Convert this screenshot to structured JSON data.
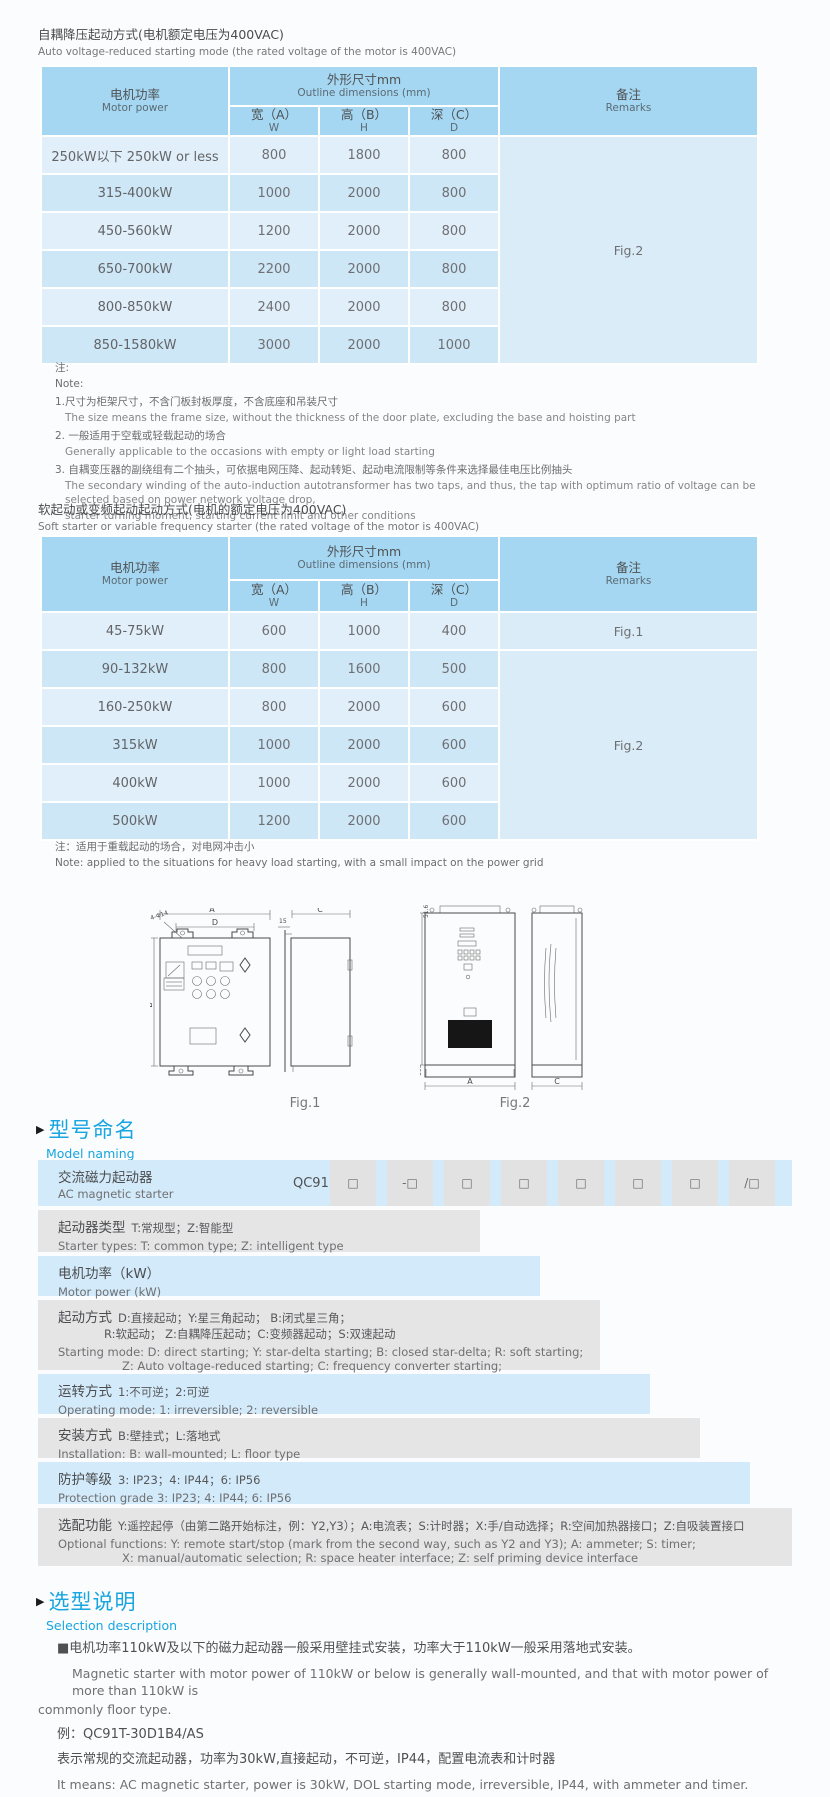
{
  "accent_blue": "#18a5e0",
  "table_header_blue": "#a5d7f2",
  "th": {
    "power_zh": "电机功率",
    "power_en": "Motor power",
    "dims_zh": "外形尺寸mm",
    "dims_en": "Outline dimensions (mm)",
    "w_zh": "宽（A）",
    "w_en": "W",
    "h_zh": "高（B）",
    "h_en": "H",
    "d_zh": "深（C）",
    "d_en": "D",
    "rem_zh": "备注",
    "rem_en": "Remarks"
  },
  "s1": {
    "title_zh": "自耦降压起动方式(电机额定电压为400VAC)",
    "title_en": "Auto voltage-reduced starting mode (the rated voltage of the motor is 400VAC)",
    "remark": "Fig.2",
    "rows": [
      {
        "power": "250kW以下 250kW or less",
        "w": "800",
        "h": "1800",
        "d": "800"
      },
      {
        "power": "315-400kW",
        "w": "1000",
        "h": "2000",
        "d": "800"
      },
      {
        "power": "450-560kW",
        "w": "1200",
        "h": "2000",
        "d": "800"
      },
      {
        "power": "650-700kW",
        "w": "2200",
        "h": "2000",
        "d": "800"
      },
      {
        "power": "800-850kW",
        "w": "2400",
        "h": "2000",
        "d": "800"
      },
      {
        "power": "850-1580kW",
        "w": "3000",
        "h": "2000",
        "d": "1000"
      }
    ],
    "notes": [
      "注:",
      "Note:",
      "1.尺寸为柜架尺寸，不含门板封板厚度，不含底座和吊装尺寸",
      "The size means the frame size, without the thickness of the door plate, excluding the base and hoisting part",
      "2. 一般适用于空载或轻载起动的场合",
      "Generally applicable to the occasions with empty or light load starting",
      "3. 自耦变压器的副绕组有二个抽头，可依据电网压降、起动转矩、起动电流限制等条件来选择最佳电压比例抽头",
      "The secondary winding of the auto-induction autotransformer has two taps, and thus, the tap with optimum ratio of voltage can be selected based on power network voltage drop,",
      "starter turning moment, starting current limit and other conditions"
    ]
  },
  "s2": {
    "title_zh": "软起动或变频起动起动方式(电机的额定电压为400VAC)",
    "title_en": "Soft starter or variable frequency starter (the rated voltage of the motor is 400VAC)",
    "remark1": "Fig.1",
    "remark2": "Fig.2",
    "rows": [
      {
        "power": "45-75kW",
        "w": "600",
        "h": "1000",
        "d": "400"
      },
      {
        "power": "90-132kW",
        "w": "800",
        "h": "1600",
        "d": "500"
      },
      {
        "power": "160-250kW",
        "w": "800",
        "h": "2000",
        "d": "600"
      },
      {
        "power": "315kW",
        "w": "1000",
        "h": "2000",
        "d": "600"
      },
      {
        "power": "400kW",
        "w": "1000",
        "h": "2000",
        "d": "600"
      },
      {
        "power": "500kW",
        "w": "1200",
        "h": "2000",
        "d": "600"
      }
    ],
    "note_zh": "注：适用于重载起动的场合，对电网冲击小",
    "note_en": "Note: applied to the situations for heavy load starting, with a small impact on the power grid"
  },
  "figures": {
    "fig1_caption": "Fig.1",
    "fig2_caption": "Fig.2",
    "fig1": {
      "a": "A",
      "d": "D",
      "holes": "4-Φ14",
      "b": "B",
      "offset": "15",
      "c": "C"
    },
    "fig2": {
      "top": "51.6",
      "b": "B",
      "plinth": "100",
      "a": "A",
      "c": "C"
    }
  },
  "naming": {
    "heading_zh": "型号命名",
    "heading_en": "Model naming",
    "marker": "▶",
    "product_zh": "交流磁力起动器",
    "product_en": "AC magnetic starter",
    "code": "QC91",
    "cells": [
      "□",
      "-□",
      "□",
      "□",
      "□",
      "□",
      "□",
      "/□"
    ],
    "rows": [
      {
        "label": "起动器类型",
        "d1": "T:常规型；Z:智能型",
        "e1": "Starter types: T: common type; Z: intelligent type"
      },
      {
        "label": "电机功率（kW）",
        "e1": "Motor power (kW)"
      },
      {
        "label": "起动方式",
        "d1": "D:直接起动；Y:星三角起动；  B:闭式星三角；",
        "d2": "R:软起动；  Z:自耦降压起动；C:变频器起动；S:双速起动",
        "e1": "Starting mode: D: direct starting; Y: star-delta starting; B: closed star-delta; R: soft starting;",
        "e2": "Z: Auto voltage-reduced starting; C: frequency converter starting;",
        "e3": "S: double speed starting"
      },
      {
        "label": "运转方式",
        "d1": "1:不可逆；2:可逆",
        "e1": "Operating mode: 1: irreversible; 2: reversible"
      },
      {
        "label": "安装方式",
        "d1": "B:壁挂式；L:落地式",
        "e1": "Installation: B: wall-mounted;  L: floor type"
      },
      {
        "label": "防护等级",
        "d1": "3: IP23；4: IP44；6: IP56",
        "e1": "Protection grade  3: IP23;  4: IP44;  6: IP56"
      },
      {
        "label": "选配功能",
        "d1": "Y:遥控起停（由第二路开始标注，例：Y2,Y3）；A:电流表；S:计时器；X:手/自动选择；R:空间加热器接口；Z:自吸装置接口",
        "e1": "Optional functions: Y: remote start/stop (mark from the second way, such as Y2 and Y3); A: ammeter; S: timer;",
        "e2": "X: manual/automatic selection; R: space heater interface; Z: self priming device interface"
      }
    ]
  },
  "selection": {
    "heading_zh": "选型说明",
    "heading_en": "Selection description",
    "marker": "▶",
    "p1_zh": "■电机功率110kW及以下的磁力起动器一般采用壁挂式安装，功率大于110kW一般采用落地式安装。",
    "p1_en1": "Magnetic starter with motor power of 110kW or below is generally wall-mounted, and that with motor power of more than 110kW is",
    "p1_en2": "commonly floor type.",
    "example": "例：QC91T-30D1B4/AS",
    "desc_zh": "表示常规的交流起动器，功率为30kW,直接起动，不可逆，IP44，配置电流表和计时器",
    "desc_en": "It means: AC magnetic starter, power is 30kW, DOL starting mode, irreversible, IP44, with ammeter and timer."
  }
}
